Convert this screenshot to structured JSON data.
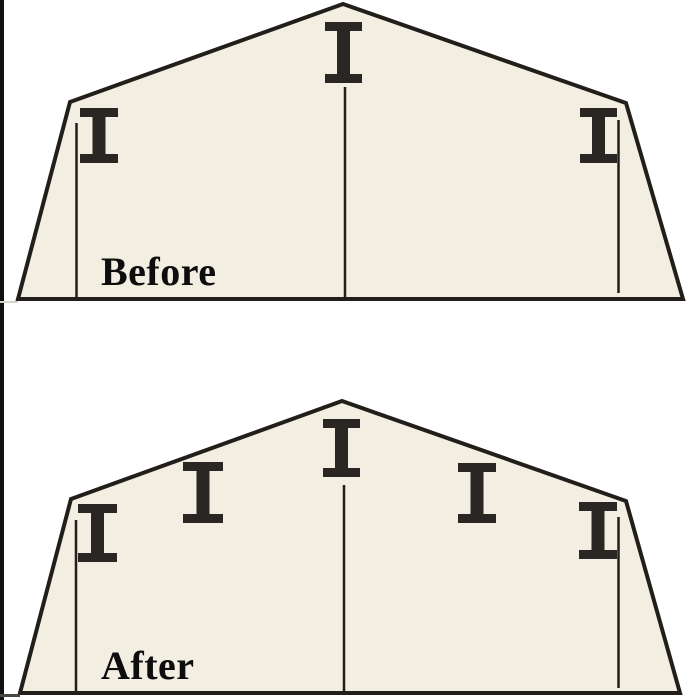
{
  "figure": {
    "description": "Cross-section of a gambrel shed shown twice, comparing interior support posts",
    "panel_count": 2
  },
  "colors": {
    "background": "#ffffff",
    "shed_fill": "#f2eee2",
    "outline": "#221f1b",
    "beam": "#2a2623",
    "label_text": "#0d0d0d",
    "edge_artifact": "#101010"
  },
  "stroke": {
    "outline_width": 4,
    "support_line_width": 2.5
  },
  "beam_style": {
    "bar_h": 9,
    "stem_w": 13
  },
  "panels": [
    {
      "id": "before",
      "label": "Before",
      "outline_points": "18,299 70,102 343,4 626,103 683,299",
      "support_lines": [
        {
          "x": 76.5,
          "y1": 123,
          "y2": 298
        },
        {
          "x": 345,
          "y1": 87,
          "y2": 298
        },
        {
          "x": 618.5,
          "y1": 120,
          "y2": 293
        }
      ],
      "ibeams": [
        {
          "cx": 99,
          "y": 108,
          "w": 38,
          "h": 55
        },
        {
          "cx": 343.5,
          "y": 22,
          "w": 37,
          "h": 61
        },
        {
          "cx": 598.5,
          "y": 108,
          "w": 37,
          "h": 55
        }
      ],
      "label_pos": {
        "x": 101,
        "y": 252
      }
    },
    {
      "id": "after",
      "label": "After",
      "outline_points": "20,693 71,499 342,401 626,501 680,693",
      "support_lines": [
        {
          "x": 76,
          "y1": 520,
          "y2": 692
        },
        {
          "x": 344,
          "y1": 485,
          "y2": 692
        },
        {
          "x": 618.5,
          "y1": 517,
          "y2": 688
        }
      ],
      "ibeams": [
        {
          "cx": 97.5,
          "y": 504,
          "w": 39,
          "h": 58
        },
        {
          "cx": 203,
          "y": 462,
          "w": 40,
          "h": 61
        },
        {
          "cx": 341.5,
          "y": 419,
          "w": 37,
          "h": 58
        },
        {
          "cx": 477,
          "y": 463,
          "w": 38,
          "h": 60
        },
        {
          "cx": 598,
          "y": 502,
          "w": 38,
          "h": 57
        }
      ],
      "label_pos": {
        "x": 101,
        "y": 646
      }
    }
  ]
}
